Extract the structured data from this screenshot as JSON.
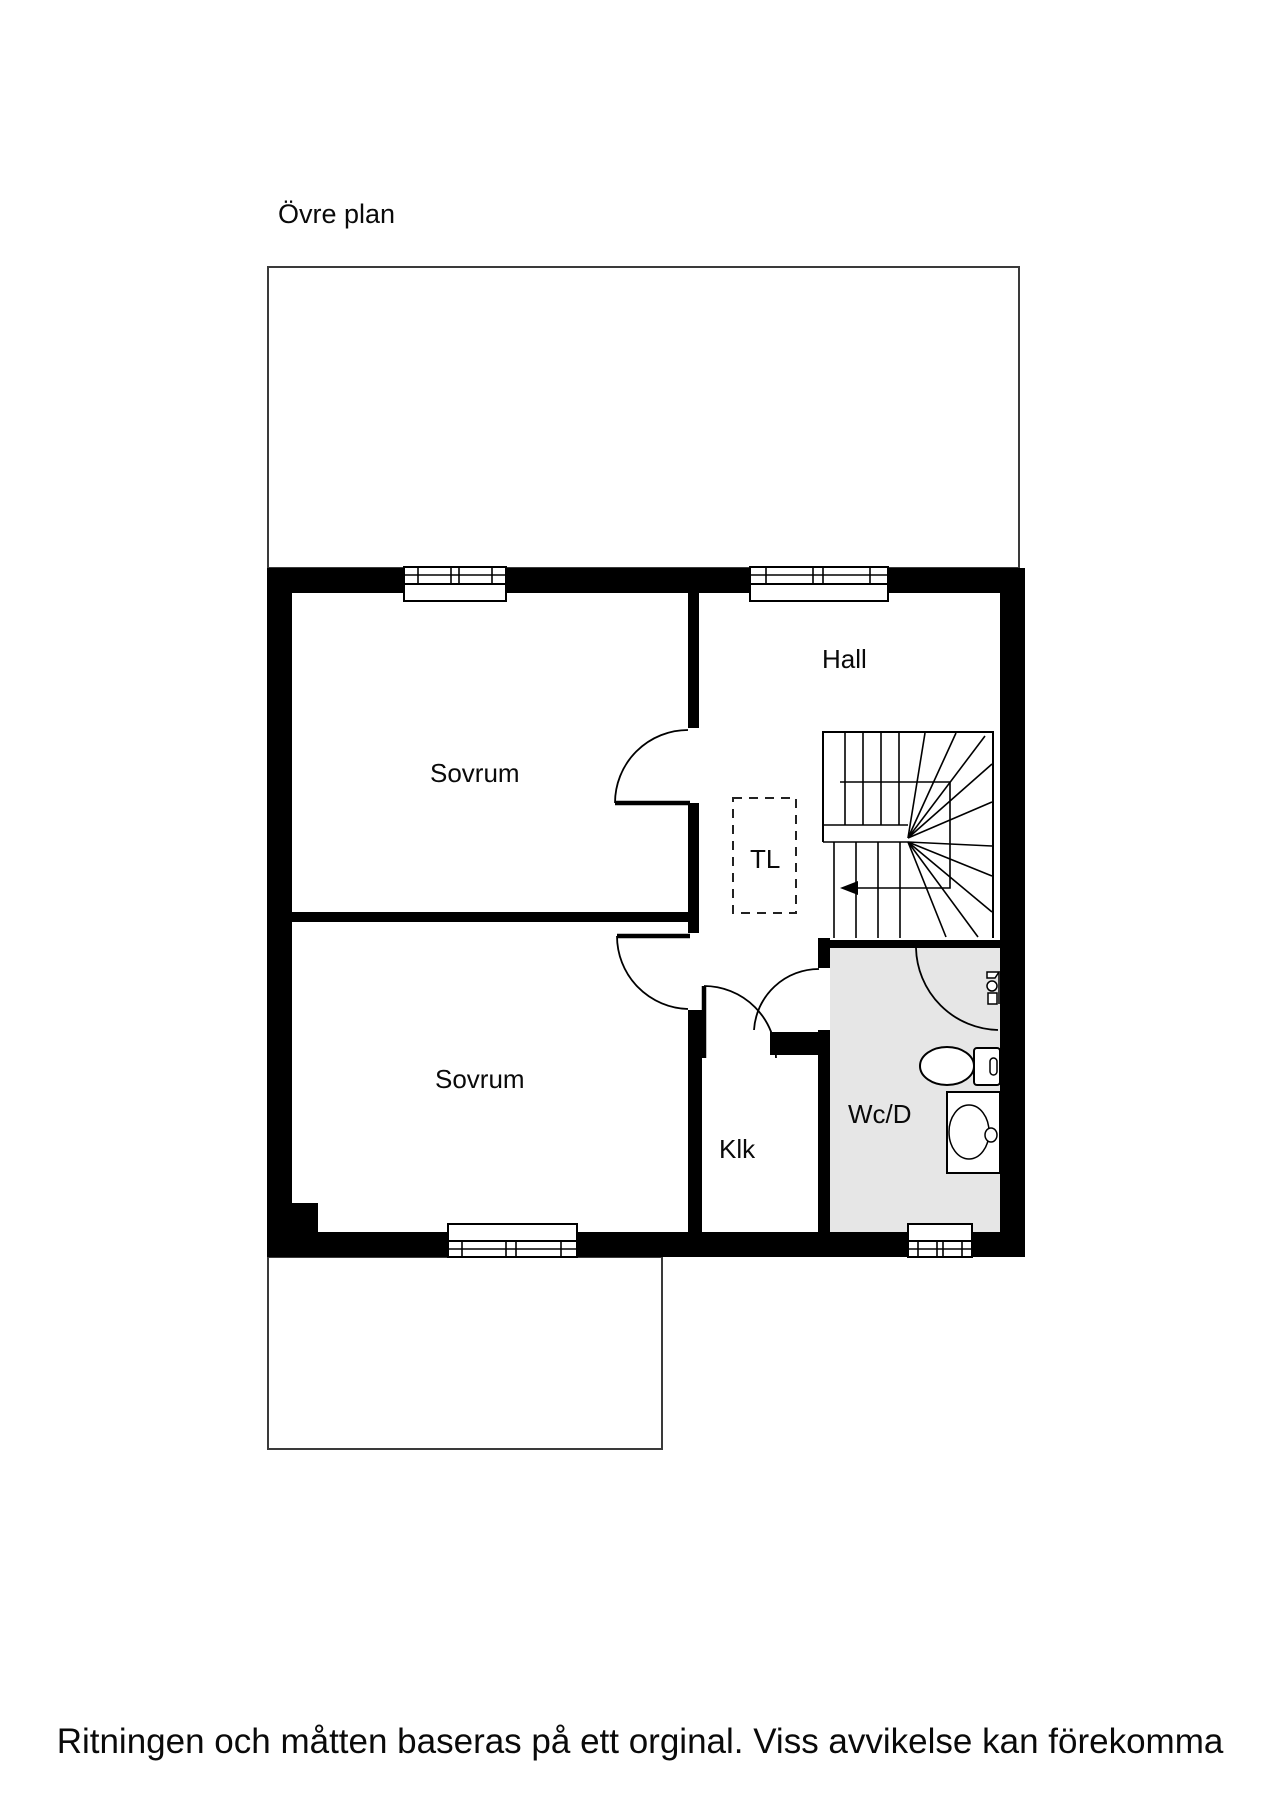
{
  "title": "Övre plan",
  "rooms": {
    "sovrum1": "Sovrum",
    "sovrum2": "Sovrum",
    "hall": "Hall",
    "tl": "TL",
    "klk": "Klk",
    "wcd": "Wc/D"
  },
  "disclaimer": "Ritningen och måtten baseras på ett orginal. Viss avvikelse kan förekomma",
  "icons": {
    "staircase": "staircase-with-winders",
    "direction_arrow": "stair-direction-arrow-left",
    "toilet": "toilet-top-view",
    "washer": "washing-machine-top-view",
    "shower": "shower-mixer",
    "windows": "window-symbol",
    "doors": "door-swing-arc"
  },
  "colors": {
    "wall": "#000000",
    "wet_room_fill": "#e6e6e6",
    "line": "#3a3a3a",
    "background": "#ffffff",
    "text": "#0a0a0a"
  }
}
